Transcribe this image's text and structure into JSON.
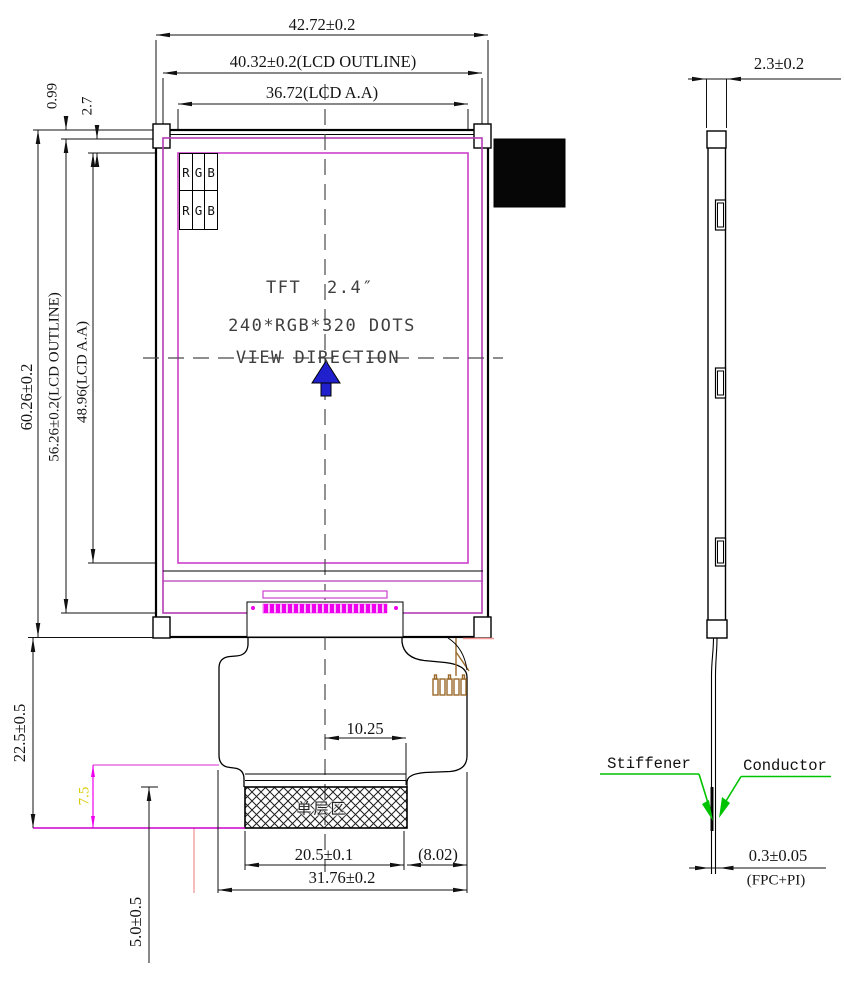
{
  "front_view": {
    "width_dims": {
      "total": "42.72±0.2",
      "outline": "40.32±0.2(LCD OUTLINE)",
      "active_area": "36.72(LCD A.A)"
    },
    "height_dims": {
      "total": "60.26±0.2",
      "outline": "56.26±0.2(LCD OUTLINE)",
      "active_area": "48.96(LCD A.A)",
      "bezel_top": "0.99",
      "aa_top": "2.7"
    },
    "fpc_dims": {
      "tail_length": "22.5±0.5",
      "stiffener_height": "7.5",
      "tail_bottom": "5.0±0.5",
      "center_offset": "10.25",
      "contact_width": "20.5±0.1",
      "edge_ref": "(8.02)",
      "tail_width": "31.76±0.2"
    },
    "screen_text": {
      "line1": "TFT 2.4″",
      "line2": "240*RGB*320 DOTS",
      "line3": "VIEW DIRECTION"
    },
    "pixel_cells": [
      "R",
      "G",
      "B"
    ],
    "hatch_label": "单层区"
  },
  "side_view": {
    "thickness": "2.3±0.2",
    "stiffener": "Stiffener",
    "conductor": "Conductor",
    "fpc_thickness": "0.3±0.05",
    "fpc_note": "(FPC+PI)"
  },
  "colors": {
    "lcd_outline": "#b43cb4",
    "active_area": "#cc3fcc",
    "bonding_strip": "#ee00ee",
    "leader_green": "#00c300",
    "view_arrow_blue": "#2020cc",
    "dim_yellow": "#d8cc00",
    "fpc_brown": "#9a6a2a",
    "ink": "#141414"
  }
}
